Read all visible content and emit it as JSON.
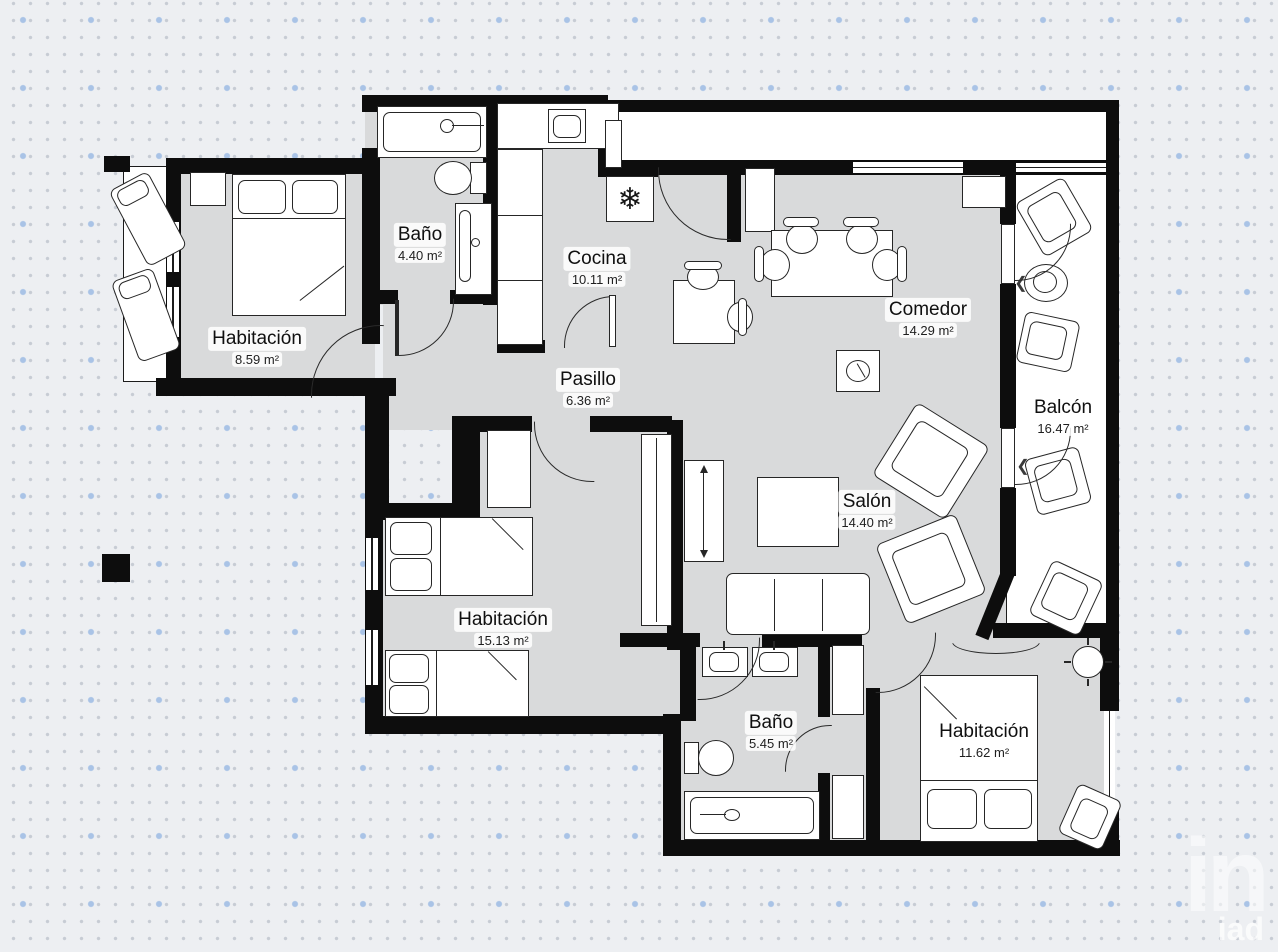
{
  "background": {
    "base_color": "#edeff2",
    "small_dot_color": "#c7ccd4",
    "accent_dot_color": "#a9c3e6"
  },
  "plan": {
    "wall_color": "#0d0d0d",
    "floor_color": "#d9dadb",
    "outdoor_color": "#ffffff",
    "rooms": [
      {
        "id": "habitacion-1",
        "name": "Habitación",
        "area": "8.59 m²"
      },
      {
        "id": "bano-1",
        "name": "Baño",
        "area": "4.40 m²"
      },
      {
        "id": "cocina",
        "name": "Cocina",
        "area": "10.11 m²"
      },
      {
        "id": "comedor",
        "name": "Comedor",
        "area": "14.29 m²"
      },
      {
        "id": "balcon",
        "name": "Balcón",
        "area": "16.47 m²"
      },
      {
        "id": "pasillo",
        "name": "Pasillo",
        "area": "6.36 m²"
      },
      {
        "id": "salon",
        "name": "Salón",
        "area": "14.40 m²"
      },
      {
        "id": "habitacion-2",
        "name": "Habitación",
        "area": "15.13 m²"
      },
      {
        "id": "bano-2",
        "name": "Baño",
        "area": "5.45 m²"
      },
      {
        "id": "habitacion-3",
        "name": "Habitación",
        "area": "11.62 m²"
      }
    ],
    "icons": {
      "fridge": "❄",
      "chevron": "❮"
    }
  },
  "watermark": {
    "mark": "in",
    "text": "iad"
  }
}
